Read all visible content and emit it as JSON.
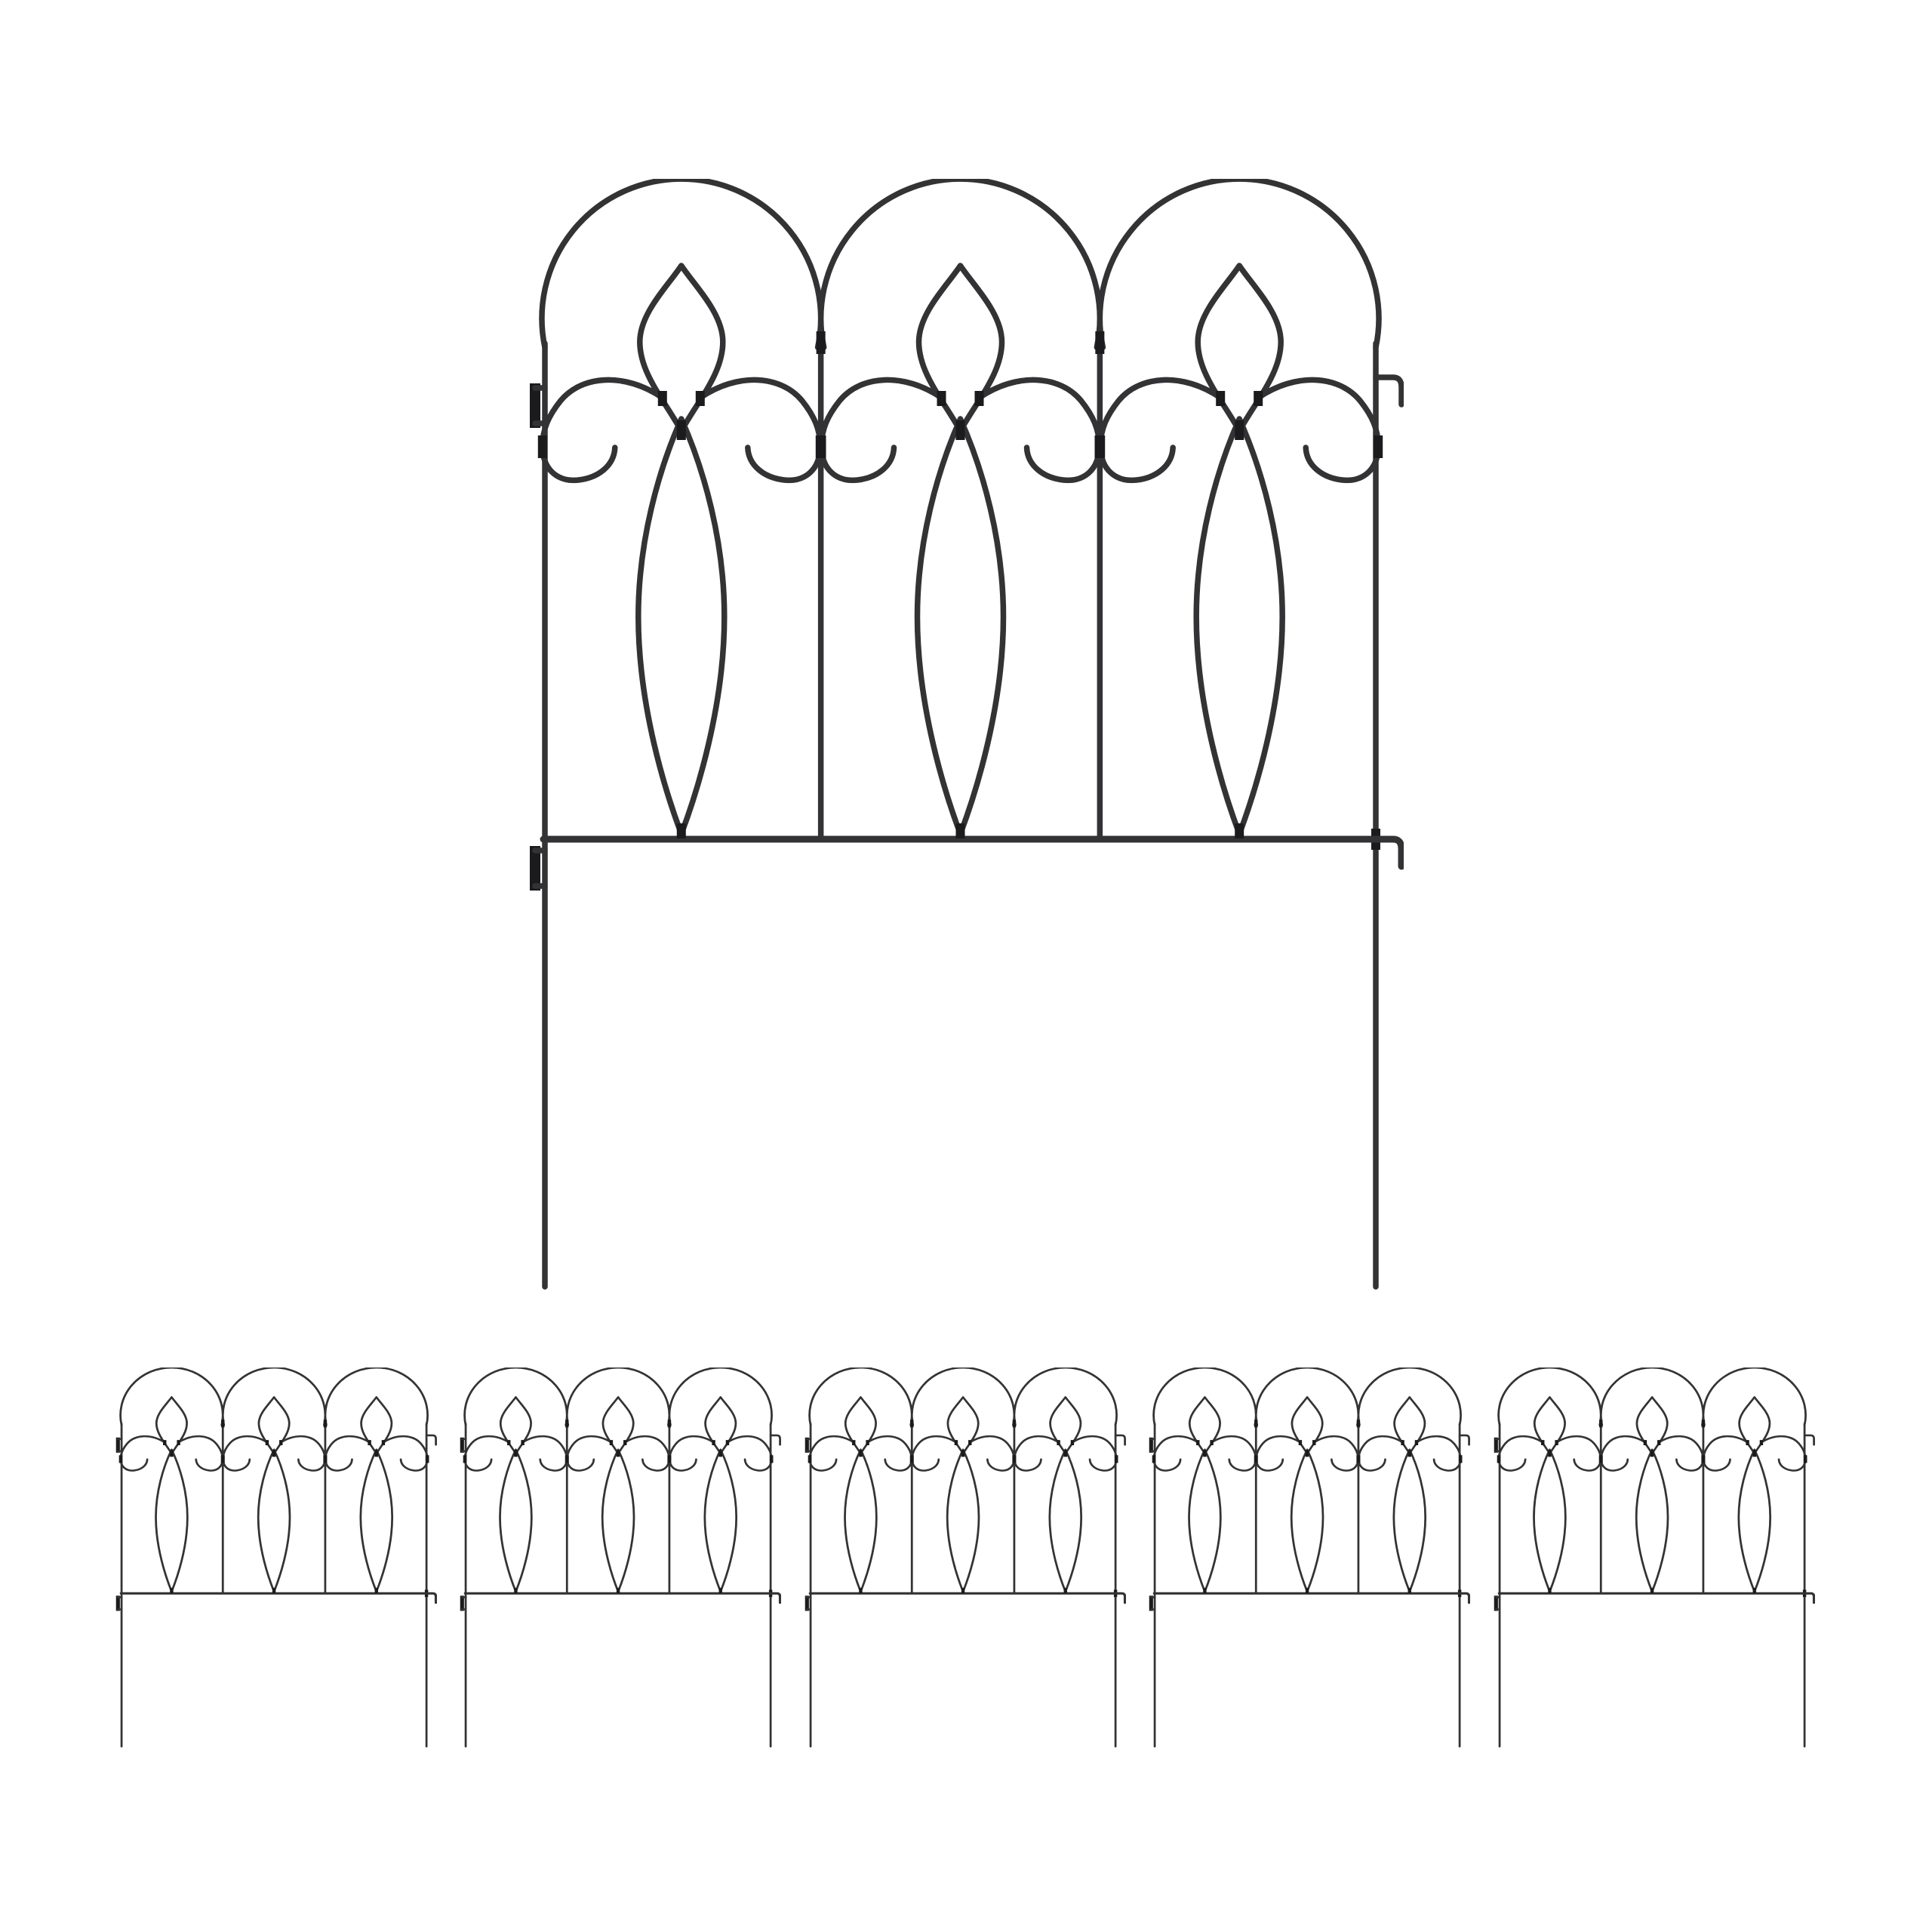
{
  "image": {
    "background_color": "#ffffff"
  },
  "fence": {
    "color": "#333335",
    "hardware_color": "#1b1b1d",
    "large_panel_count": 1,
    "small_panel_count": 5,
    "arches_per_panel": 3,
    "ornaments_per_arch": [
      "lens-loop",
      "teardrop-loop",
      "left-scroll",
      "right-scroll"
    ],
    "stakes_per_panel": 2,
    "left_clips_per_panel": 2,
    "right_hooks_per_panel": 2
  }
}
